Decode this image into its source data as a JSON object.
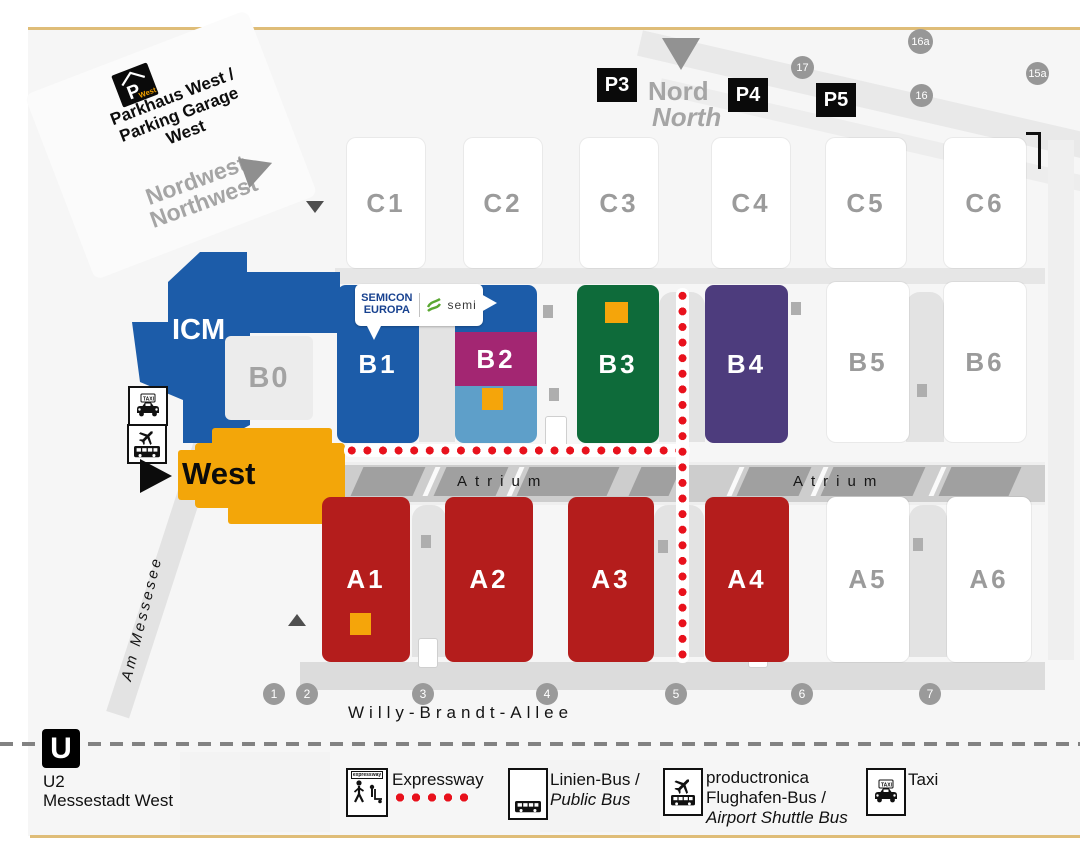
{
  "colors": {
    "hall_a_red": "#b41d1c",
    "hall_b_blue": "#1c5ca9",
    "b2_magenta": "#a32672",
    "b2_light_blue": "#5e9fc9",
    "b3_green": "#0e6b3a",
    "b4_purple": "#4d3c7d",
    "west_orange": "#f3a609",
    "marker_orange": "#f5a50a",
    "expressway_red": "#e8111c",
    "frame_tan": "#dfbd78",
    "gray_label": "#9b9b9b",
    "semicon_blue": "#17418f",
    "semi_green": "#5aa832"
  },
  "map": {
    "parkhaus": {
      "icon_p": "P",
      "icon_west": "West",
      "lines": [
        "Parkhaus West /",
        "Parking Garage",
        "West"
      ]
    },
    "entrances": {
      "northwest": {
        "de": "Nordwest",
        "en": "Northwest"
      },
      "north": {
        "de": "Nord",
        "en": "North"
      },
      "west": {
        "label": "West"
      }
    },
    "parking": [
      "P3",
      "P4",
      "P5"
    ],
    "gates": [
      "16a",
      "17",
      "16",
      "15a"
    ],
    "halls": {
      "c_row": [
        "C1",
        "C2",
        "C3",
        "C4",
        "C5",
        "C6"
      ],
      "b_row": [
        "B1",
        "B2",
        "B3",
        "B4",
        "B5",
        "B6"
      ],
      "a_row": [
        "A1",
        "A2",
        "A3",
        "A4",
        "A5",
        "A6"
      ],
      "b0": "B0",
      "icm": "ICM"
    },
    "atrium": "Atrium",
    "streets": {
      "main": "Willy-Brandt-Allee",
      "lake": "Am Messesee"
    },
    "street_markers": [
      "1",
      "2",
      "3",
      "4",
      "5",
      "6",
      "7"
    ],
    "subway": {
      "logo": "U",
      "line": "U2",
      "station": "Messestadt West"
    },
    "semicon": {
      "line1": "SEMICON",
      "line2": "EUROPA",
      "semi": "semi"
    }
  },
  "legend": {
    "expressway": {
      "icon_text": "expressway",
      "label": "Expressway"
    },
    "public_bus": {
      "line1": "Linien-Bus /",
      "line2": "Public Bus"
    },
    "airport_shuttle": {
      "line1": "productronica",
      "line2": "Flughafen-Bus /",
      "line3": "Airport Shuttle Bus"
    },
    "taxi": {
      "icon_text": "TAXI",
      "label": "Taxi"
    }
  }
}
